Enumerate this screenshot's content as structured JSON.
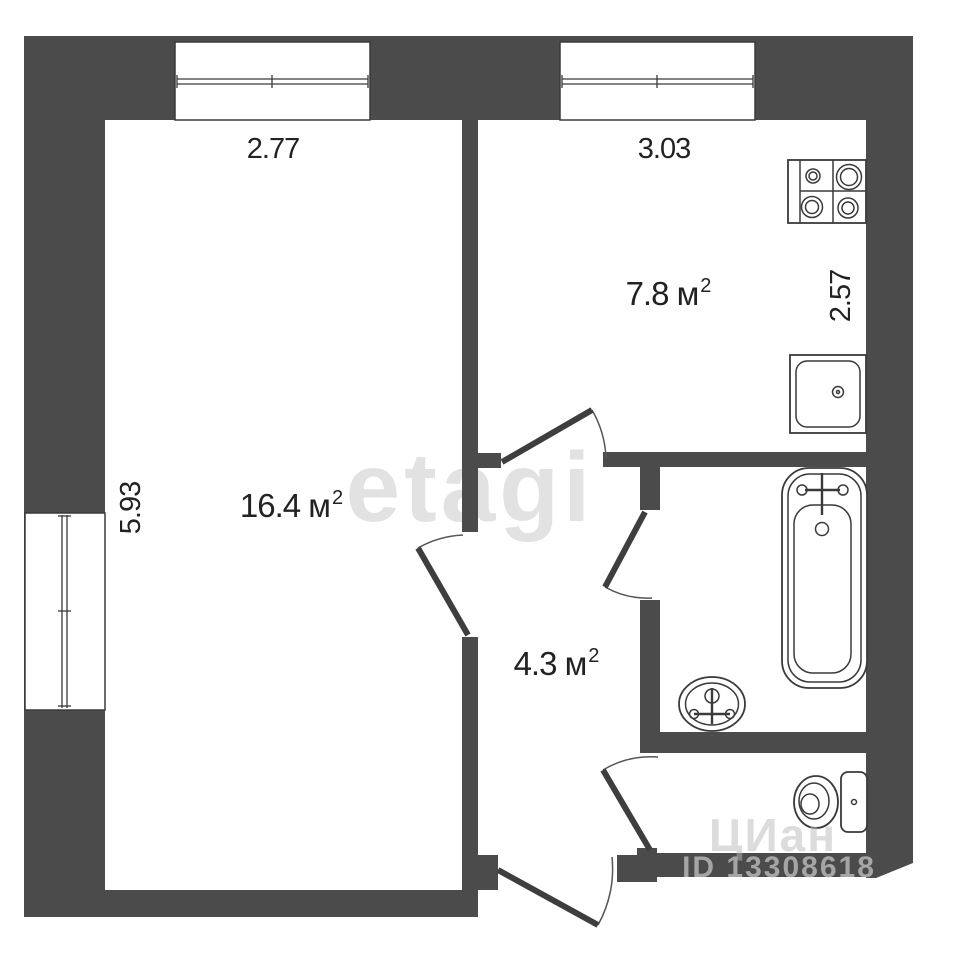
{
  "plan": {
    "watermark_brand": "etagi",
    "watermark_corner": "ЦИан",
    "listing_id": "ID 13308618",
    "rooms": {
      "living": {
        "area": "16.4 м",
        "sup": "2"
      },
      "kitchen": {
        "area": "7.8 м",
        "sup": "2"
      },
      "hallway": {
        "area": "4.3 м",
        "sup": "2"
      }
    },
    "dimensions": {
      "living_width": "2.77",
      "kitchen_width": "3.03",
      "kitchen_depth": "2.57",
      "living_depth": "5.93"
    },
    "colors": {
      "wall": "#4b4b4b",
      "line": "#3a3a3a",
      "text": "#222222"
    }
  }
}
